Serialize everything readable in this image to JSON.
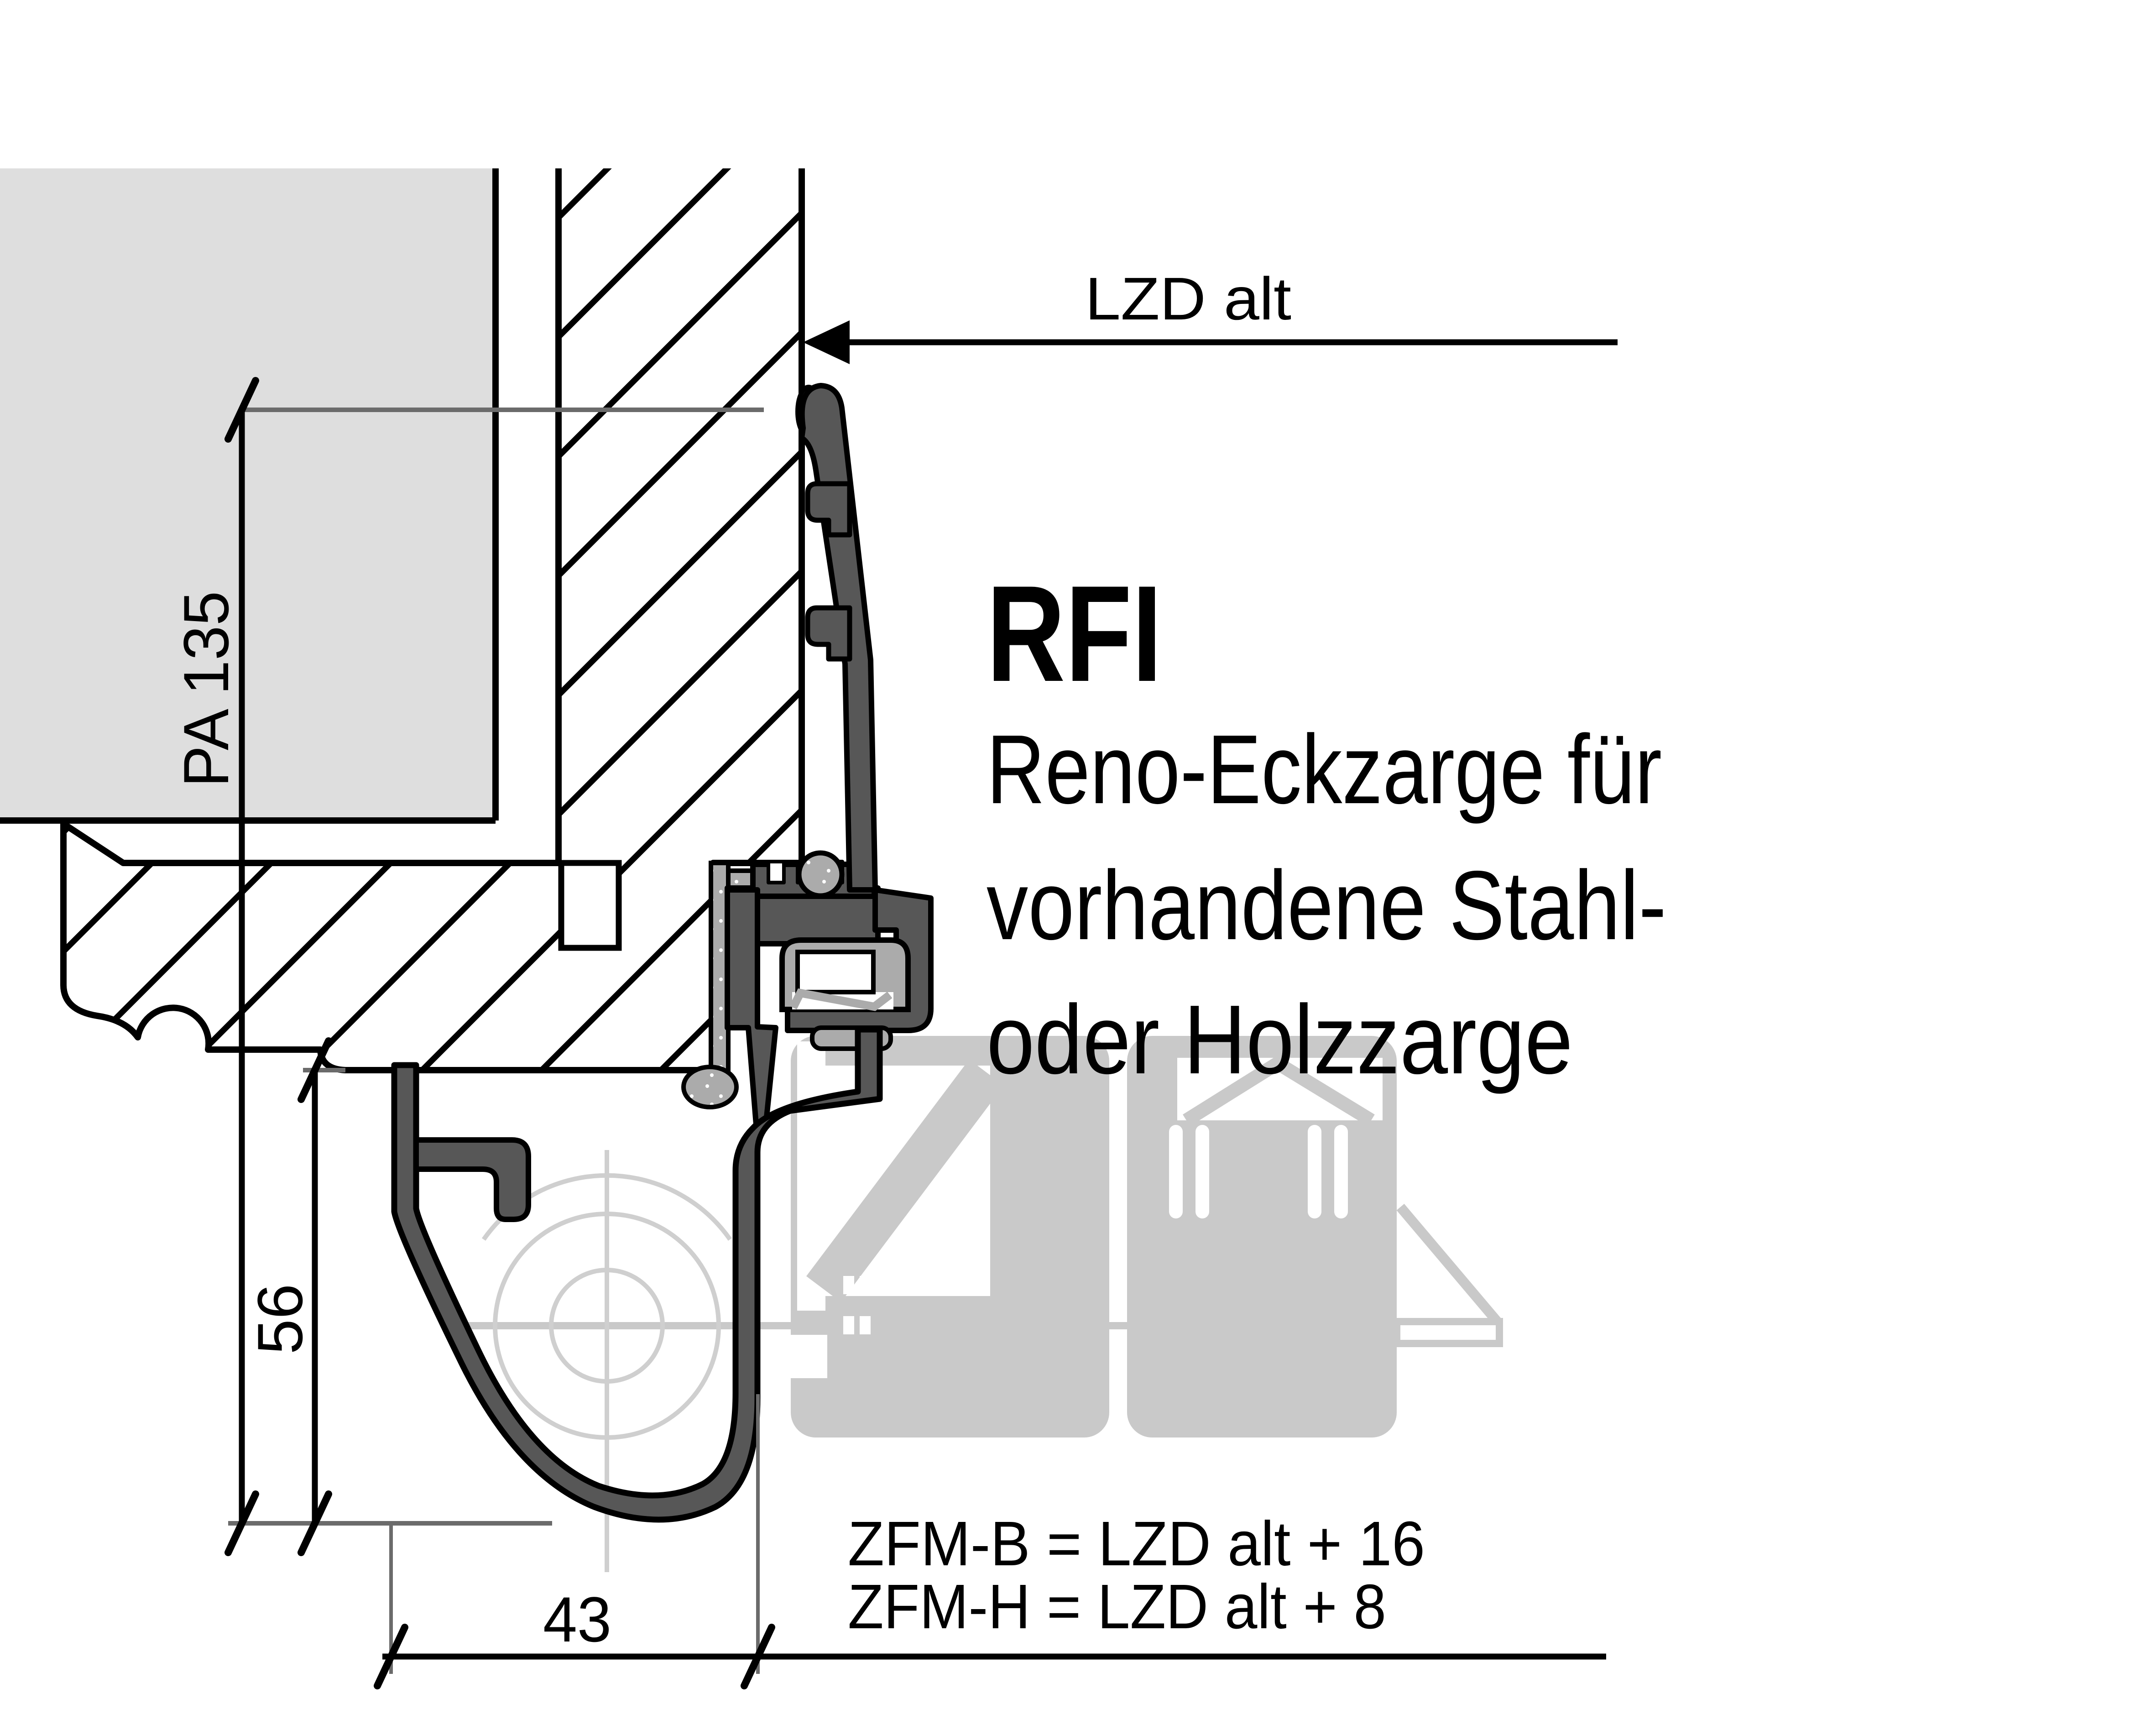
{
  "drawing": {
    "product_code": "RFI",
    "description_lines": [
      "Reno-Eckzarge für",
      "vorhandene Stahl-",
      "oder Holzzarge"
    ],
    "formulas": [
      "ZFM-B = LZD alt + 16",
      "ZFM-H = LZD alt + 8"
    ],
    "dimensions": {
      "opening_label": "LZD alt",
      "profile_depth": "PA 135",
      "profile_height": "56",
      "profile_width": "43"
    },
    "colors": {
      "profile_dark": "#575757",
      "seal_gray": "#ababab",
      "ghost_gray": "#c9c9c9",
      "plaster_gray": "#dedede",
      "dimension_gray": "#6b6b6b",
      "centerline_gray": "#cfcfcf",
      "outline_black": "#000000"
    }
  }
}
